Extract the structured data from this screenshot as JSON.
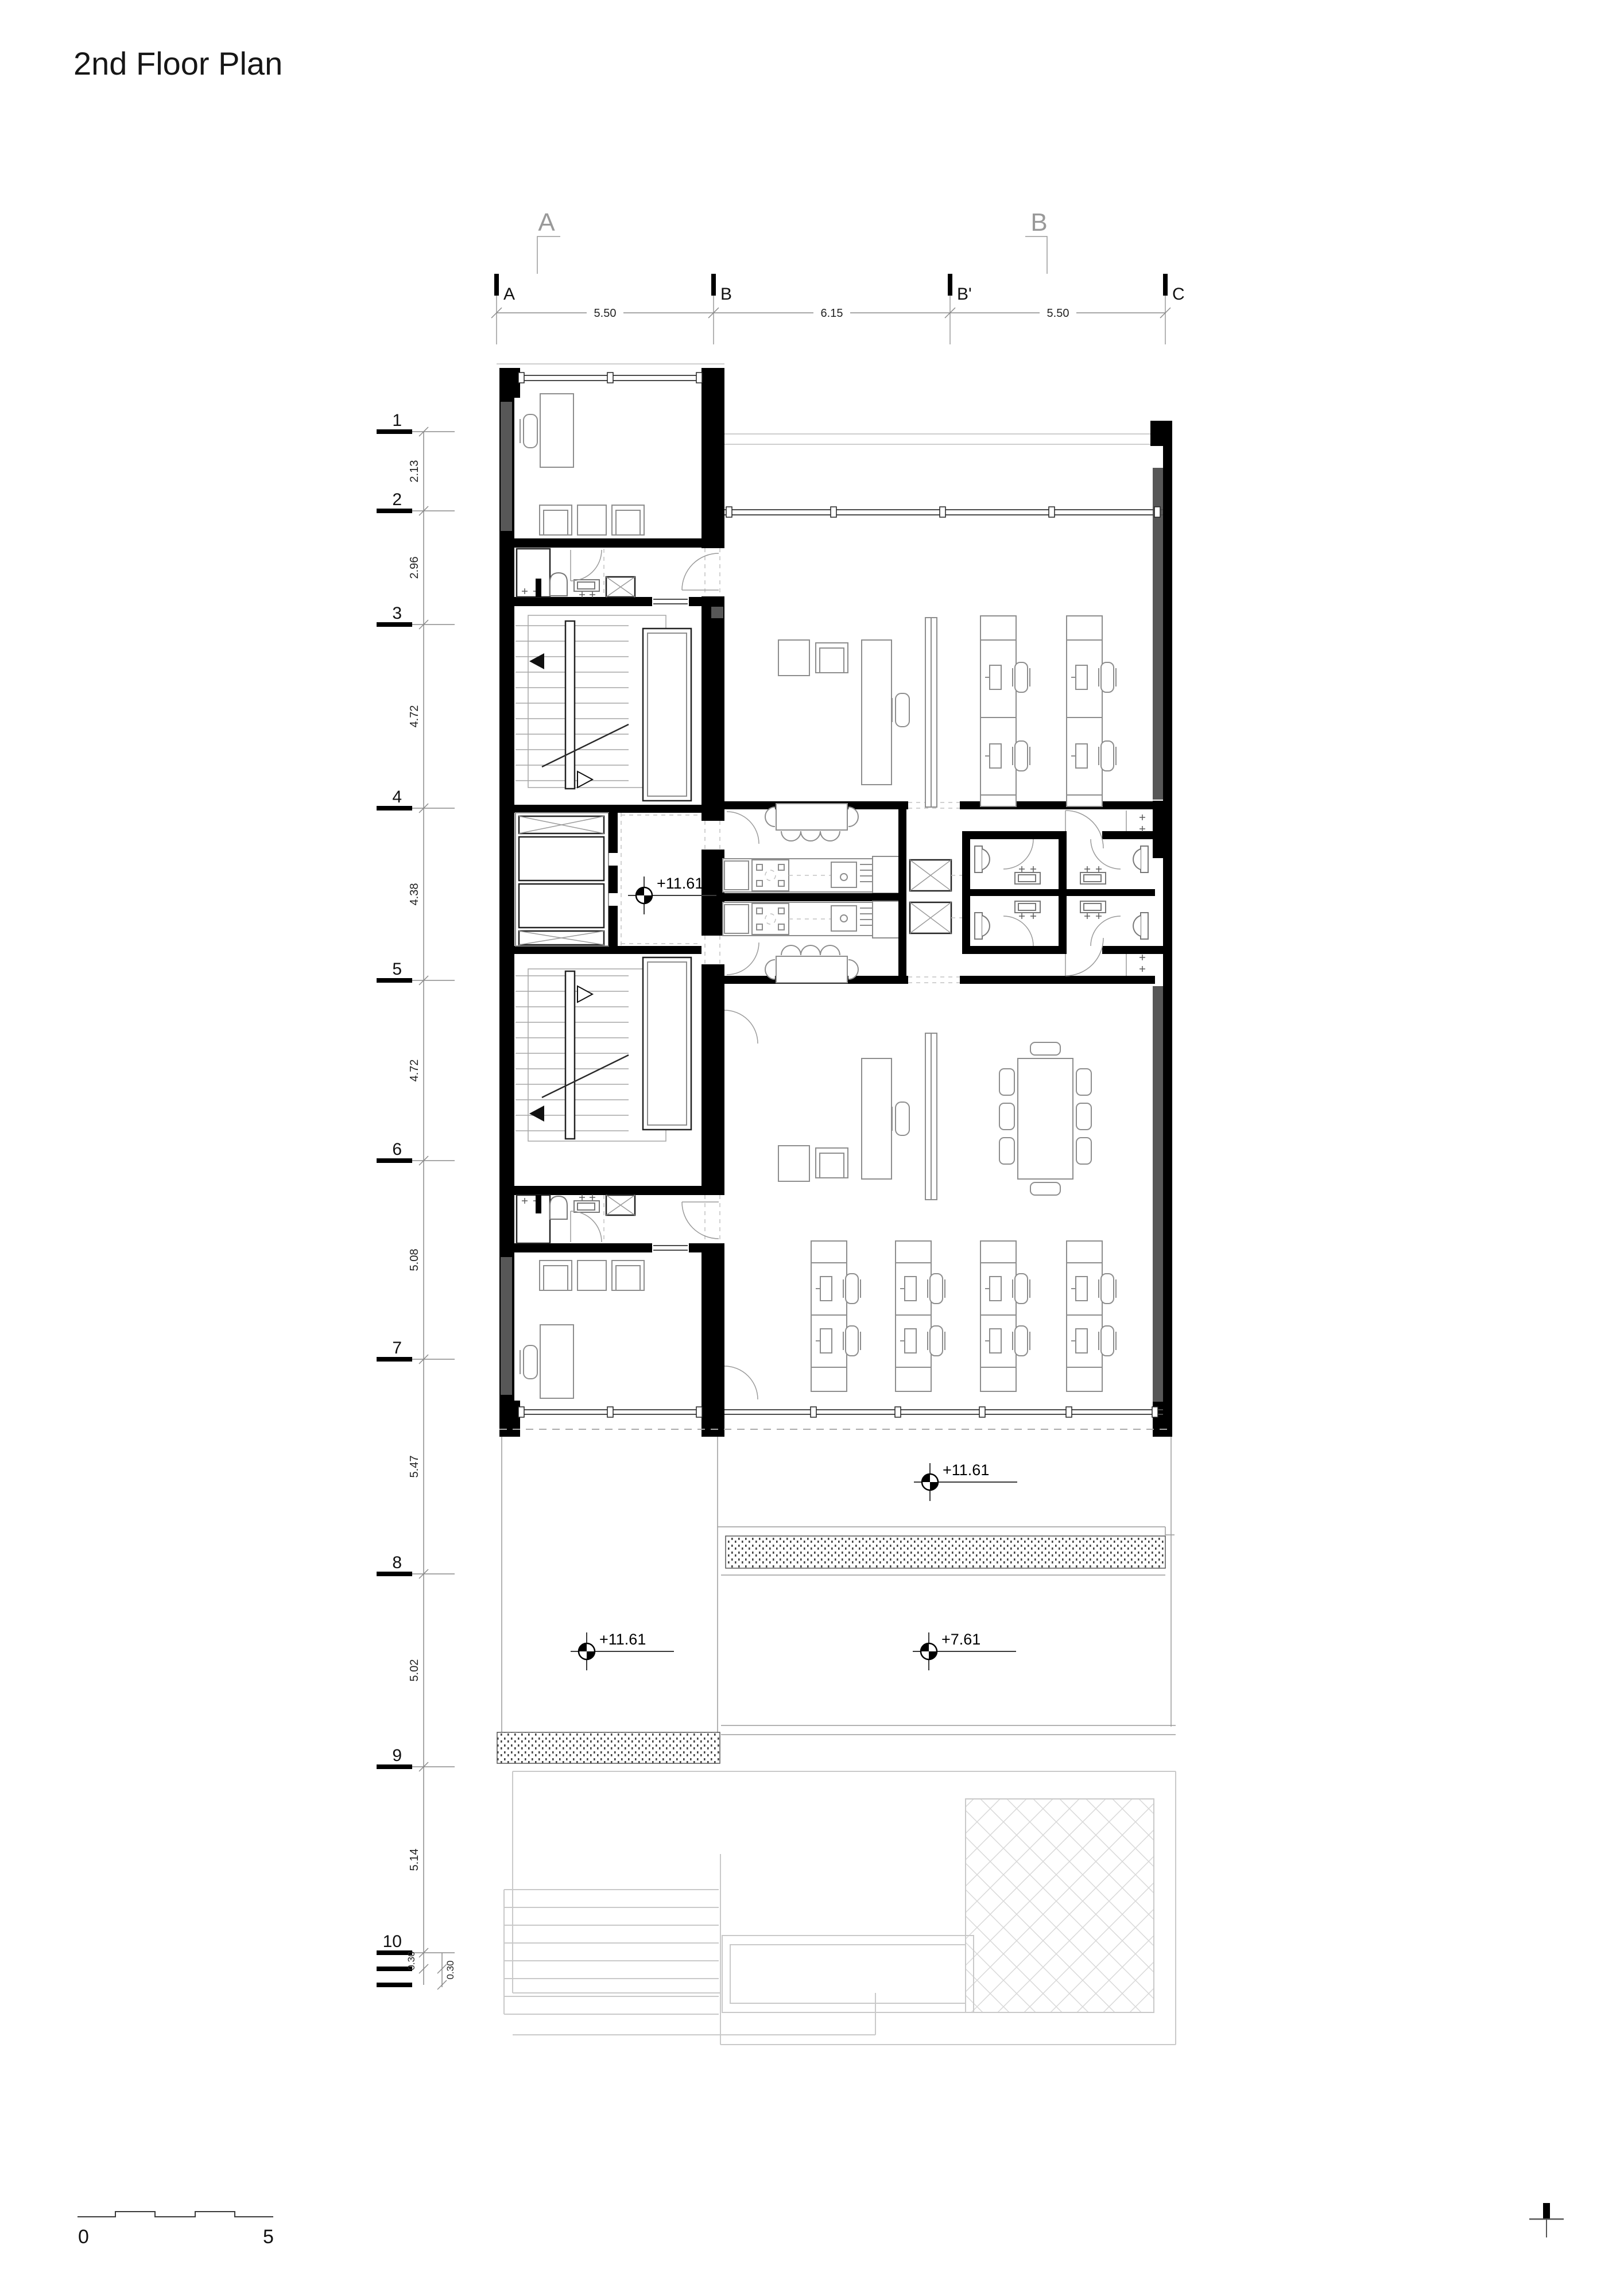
{
  "title": "2nd Floor Plan",
  "colors": {
    "wall": "#000000",
    "poche": "#575757",
    "line": "#8d8d8d",
    "faint": "#c9c9c9"
  },
  "sections": [
    {
      "label": "A"
    },
    {
      "label": "B"
    }
  ],
  "grid": {
    "cols": [
      {
        "label": "A"
      },
      {
        "label": "B"
      },
      {
        "label": "B'"
      },
      {
        "label": "C"
      }
    ],
    "col_dims": [
      "5.50",
      "6.15",
      "5.50"
    ],
    "rows": [
      {
        "label": "1"
      },
      {
        "label": "2"
      },
      {
        "label": "3"
      },
      {
        "label": "4"
      },
      {
        "label": "5"
      },
      {
        "label": "6"
      },
      {
        "label": "7"
      },
      {
        "label": "8"
      },
      {
        "label": "9"
      },
      {
        "label": "10"
      }
    ],
    "row_dims": [
      "2.13",
      "2.96",
      "4.72",
      "4.38",
      "4.72",
      "5.08",
      "5.47",
      "5.02",
      "5.14"
    ],
    "row_dims_small": [
      "0.30",
      "0.30"
    ]
  },
  "levels": {
    "core": "+11.61",
    "terrace_upper": "+11.61",
    "terrace_left": "+11.61",
    "roof_lower": "+7.61"
  },
  "scale_bar": {
    "start": "0",
    "end": "5"
  }
}
